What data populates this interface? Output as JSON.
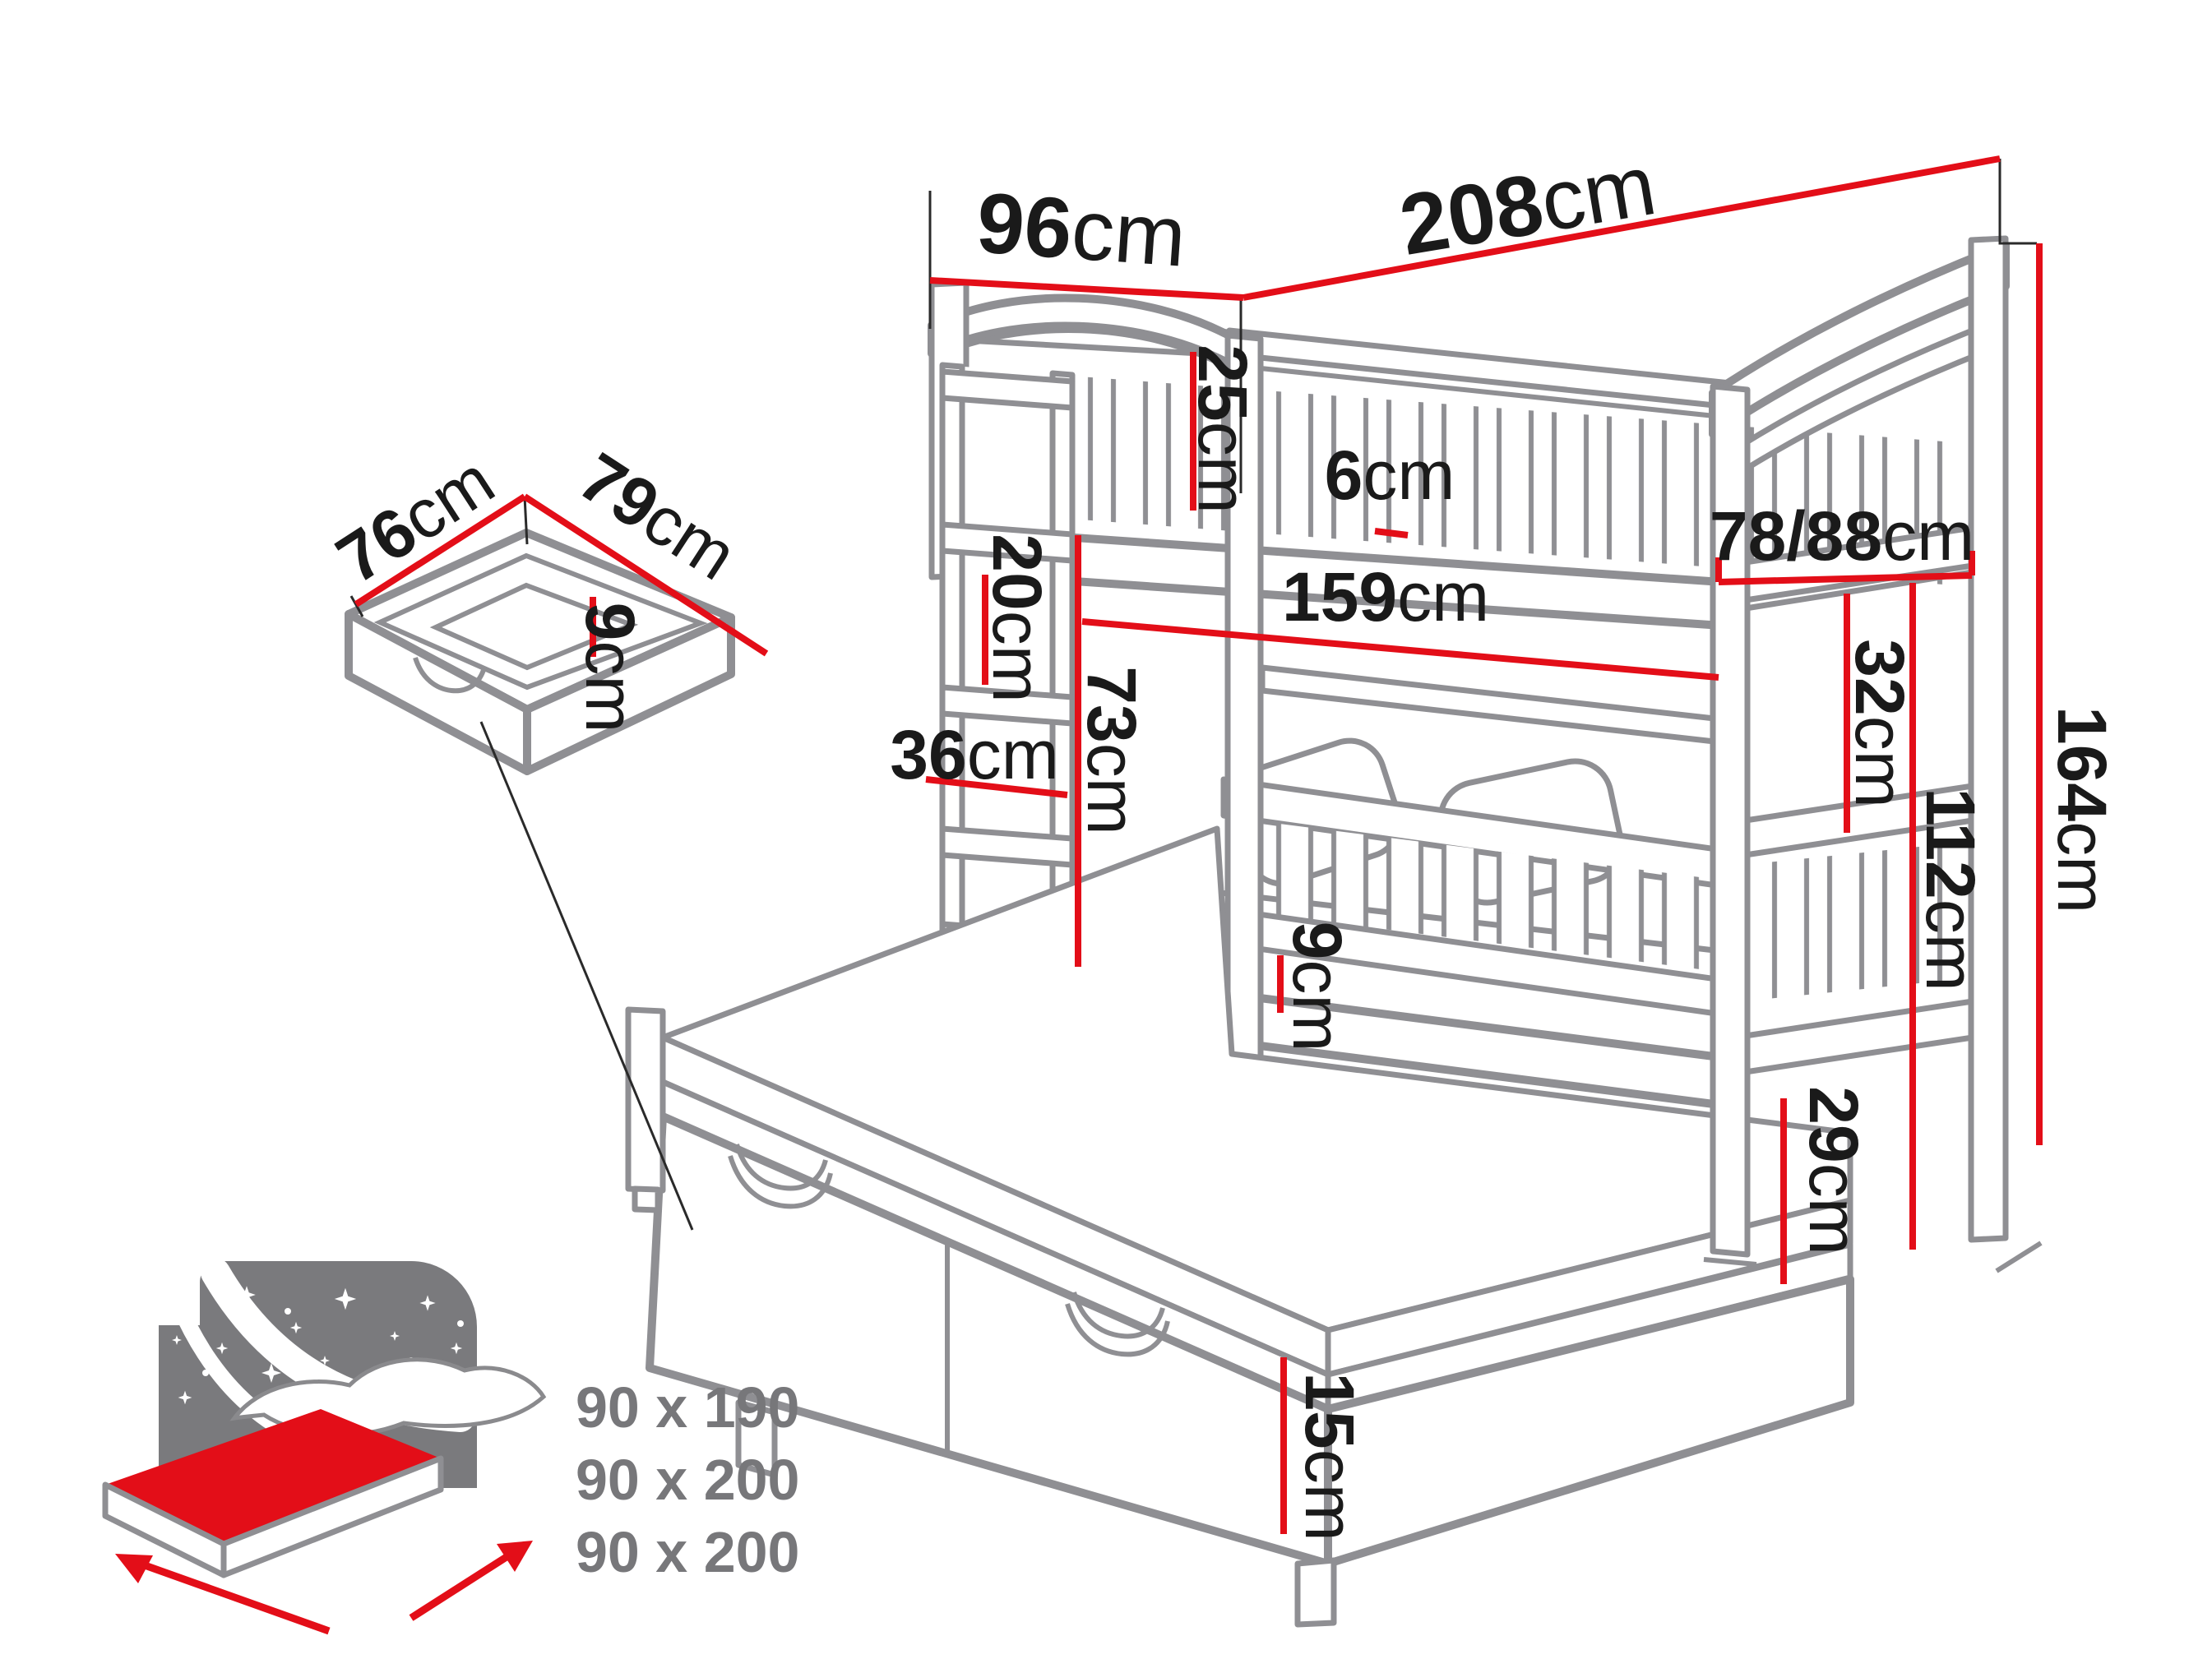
{
  "units": {
    "cm": "cm"
  },
  "dims": {
    "top_width": {
      "v": "96",
      "u": "cm"
    },
    "top_length": {
      "v": "208",
      "u": "cm"
    },
    "upper_guardrail_height": {
      "v": "25",
      "u": "cm"
    },
    "slat_gap": {
      "v": "6",
      "u": "cm"
    },
    "end_width": {
      "v": "78/88",
      "u": "cm"
    },
    "inner_length": {
      "v": "159",
      "u": "cm"
    },
    "upper_panel_height": {
      "v": "32",
      "u": "cm"
    },
    "shelf_spacing": {
      "v": "20",
      "u": "cm"
    },
    "shelf_depth": {
      "v": "36",
      "u": "cm"
    },
    "bunk_clearance": {
      "v": "73",
      "u": "cm"
    },
    "total_height": {
      "v": "164",
      "u": "cm"
    },
    "under_upper_height": {
      "v": "112",
      "u": "cm"
    },
    "floor_clearance": {
      "v": "29",
      "u": "cm"
    },
    "rail_mattress_gap": {
      "v": "9",
      "u": "cm"
    },
    "trundle_side_height": {
      "v": "15",
      "u": "cm"
    },
    "drawer_depth": {
      "v": "76",
      "u": "cm"
    },
    "drawer_width": {
      "v": "79",
      "u": "cm"
    },
    "drawer_height": {
      "v": "9",
      "u": "cm"
    }
  },
  "mattress_sizes": [
    "90 x 190",
    "90 x 200",
    "90 x 200"
  ],
  "colors": {
    "dimension_red": "#e30e18",
    "outline_gray": "#8f8f93",
    "label_black": "#1a1a1a",
    "muted_gray": "#77777a"
  }
}
